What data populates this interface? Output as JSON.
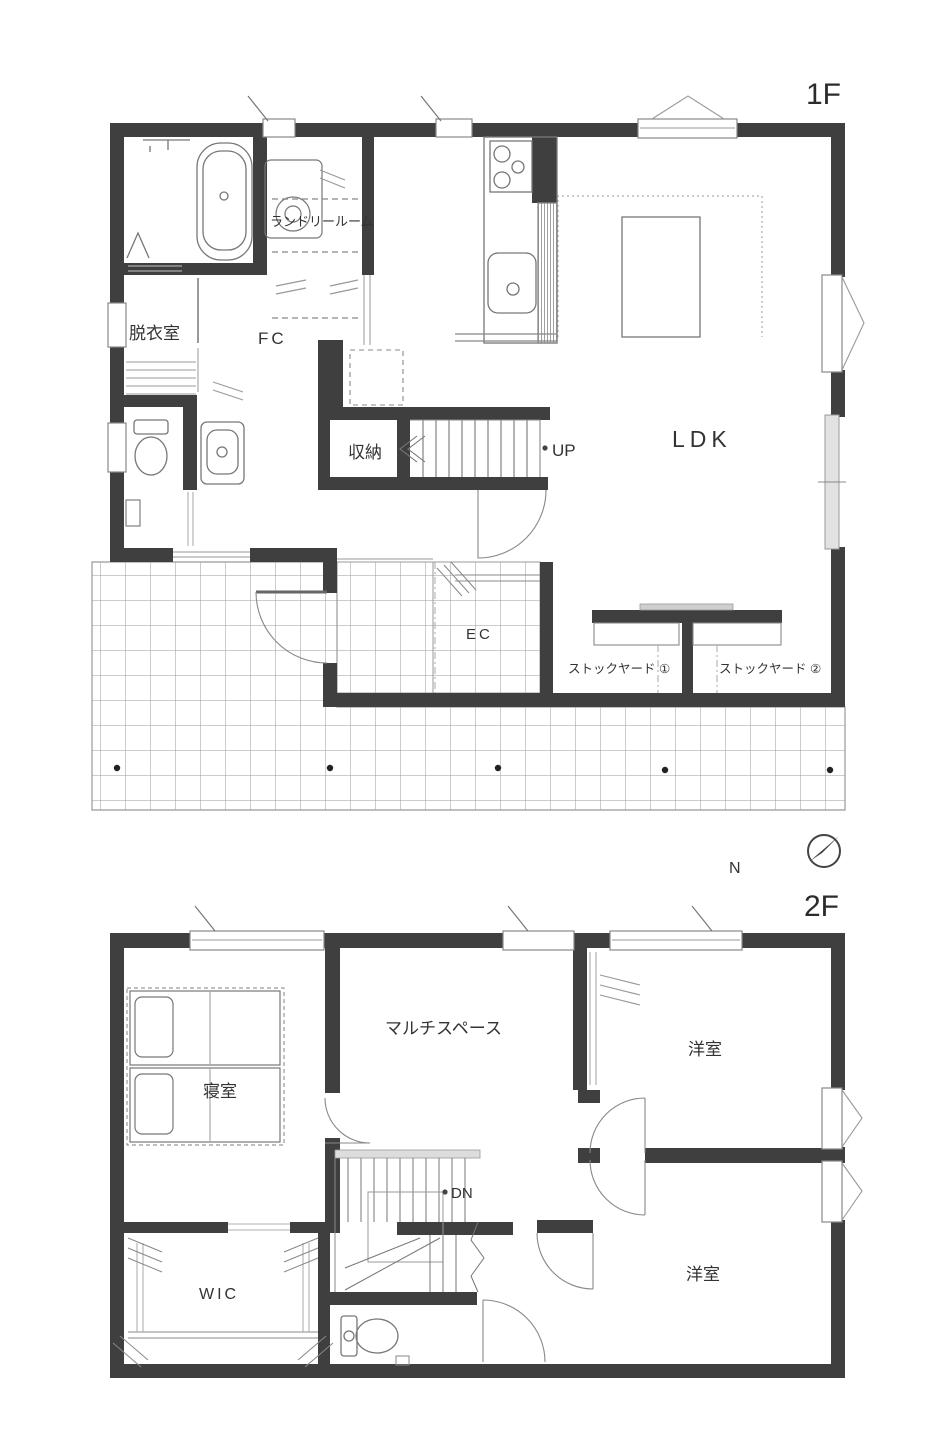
{
  "drawing": {
    "type": "architectural floor plan (Japanese residence)",
    "colors": {
      "wall": "#3f3f3f",
      "fixture_line": "#777777",
      "light_line": "#aaaaaa",
      "tile_line": "#9a9a9a",
      "text": "#333333",
      "background": "#ffffff"
    }
  },
  "floors": {
    "f1": {
      "floor_label": "1F",
      "rooms": {
        "laundry": "ランドリールーム",
        "dressing": "脱衣室",
        "fc": "FC",
        "storage": "収納",
        "ldk": "LDK",
        "ec": "EC",
        "stockyard1": "ストックヤード ①",
        "stockyard2": "ストックヤード ②"
      },
      "stairs_up": "UP"
    },
    "f2": {
      "floor_label": "2F",
      "compass_north": "N",
      "rooms": {
        "bedroom": "寝室",
        "multi_space": "マルチスペース",
        "western_room_1": "洋室",
        "western_room_2": "洋室",
        "wic": "WIC"
      },
      "stairs_down": "DN"
    }
  }
}
